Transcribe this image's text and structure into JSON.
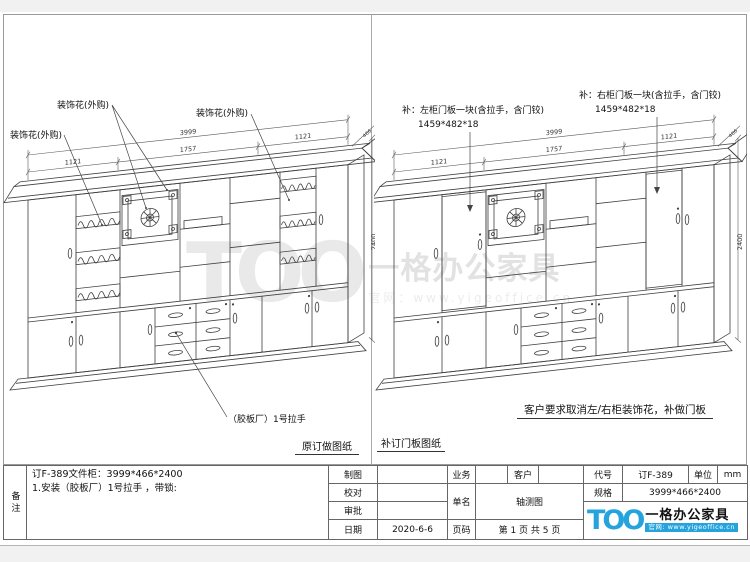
{
  "watermark": {
    "mark": "TOO",
    "brand": "一格办公家具",
    "site": "官网：www.yigeoffice.cn"
  },
  "left_panel": {
    "caption": "原订做图纸",
    "label_deco_top": "装饰花(外购)",
    "label_deco_left": "装饰花(外购)",
    "label_deco_right": "装饰花(外购)",
    "label_handle": "（胶板厂）1号拉手",
    "dims": {
      "total": "3999",
      "mid": "1757",
      "left": "1121",
      "right": "1121",
      "depth": "466",
      "height": "2400"
    }
  },
  "right_panel": {
    "caption": "补订门板图纸",
    "note": "客户要求取消左/右柜装饰花，补做门板",
    "label_left_door": "补：左柜门板一块(含拉手，含门铰)",
    "label_left_door_size": "1459*482*18",
    "label_right_door": "补：右柜门板一块(含拉手，含门铰)",
    "label_right_door_size": "1459*482*18",
    "dims": {
      "total": "3999",
      "mid": "1757",
      "left": "1121",
      "right": "1121",
      "depth": "466",
      "height": "2400"
    }
  },
  "titleblock": {
    "beizhu": "备注",
    "note_line1": "订F-389文件柜：3999*466*2400",
    "note_line2": "1.安装（胶板厂）1号拉手 ，带锁:",
    "zhitu": "制图",
    "jiaodui": "校对",
    "shenpi": "审批",
    "riqi": "日期",
    "date_value": "2020-6-6",
    "yewu": "业务",
    "kehu": "客户",
    "danming": "单名",
    "danming_value": "轴测图",
    "yema": "页码",
    "yema_value": "第 1 页 共 5 页",
    "daihao": "代号",
    "daihao_value": "订F-389",
    "danwei": "单位",
    "danwei_value": "mm",
    "guige": "规格",
    "guige_value": "3999*466*2400"
  },
  "logo": {
    "mark": "TOO",
    "brand": "一格办公家具",
    "site": "官网: www.yigeoffice.cn"
  }
}
